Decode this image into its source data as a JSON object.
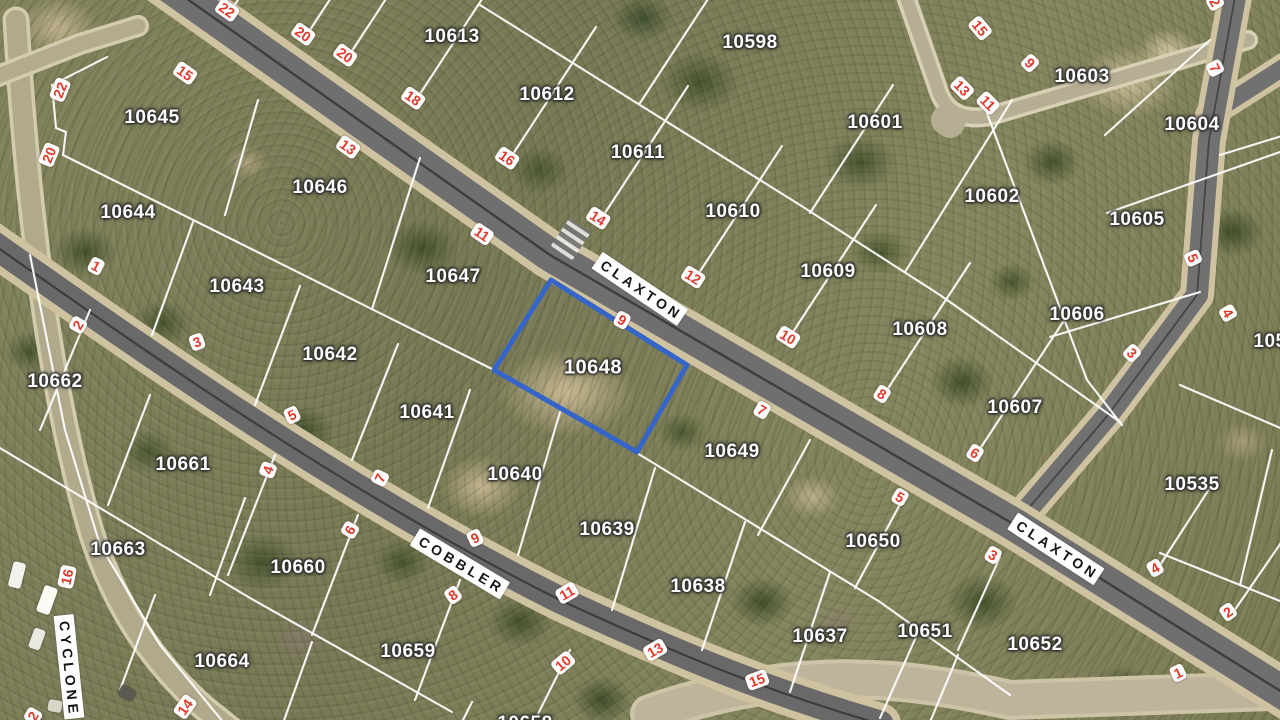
{
  "map": {
    "highlight_color": "#3565c8",
    "boundary_color": "#ffffff",
    "street_number_color": "#e23a2a",
    "selected_parcel": "10648",
    "highlight_parcel": {
      "id": "10648",
      "points": "551,280 687,365 637,452 494,370"
    },
    "street_names": [
      {
        "t": "CLAXTON",
        "x": 640,
        "y": 289,
        "r": 34
      },
      {
        "t": "CLAXTON",
        "x": 1056,
        "y": 549,
        "r": 33
      },
      {
        "t": "COBBLER",
        "x": 460,
        "y": 564,
        "r": 31
      },
      {
        "t": "CYCLONE",
        "x": 69,
        "y": 667,
        "r": 84
      }
    ],
    "parcel_labels": [
      {
        "t": "10613",
        "x": 452,
        "y": 37
      },
      {
        "t": "10612",
        "x": 547,
        "y": 95
      },
      {
        "t": "10611",
        "x": 638,
        "y": 153
      },
      {
        "t": "10610",
        "x": 733,
        "y": 212
      },
      {
        "t": "10609",
        "x": 828,
        "y": 272
      },
      {
        "t": "10608",
        "x": 920,
        "y": 330
      },
      {
        "t": "10607",
        "x": 1015,
        "y": 408
      },
      {
        "t": "10598",
        "x": 750,
        "y": 43
      },
      {
        "t": "10601",
        "x": 875,
        "y": 123
      },
      {
        "t": "10602",
        "x": 992,
        "y": 197
      },
      {
        "t": "10603",
        "x": 1082,
        "y": 77
      },
      {
        "t": "10604",
        "x": 1192,
        "y": 125
      },
      {
        "t": "10605",
        "x": 1137,
        "y": 220
      },
      {
        "t": "10606",
        "x": 1077,
        "y": 315
      },
      {
        "t": "10535",
        "x": 1192,
        "y": 485
      },
      {
        "t": "105",
        "x": 1270,
        "y": 342
      },
      {
        "t": "10645",
        "x": 152,
        "y": 118
      },
      {
        "t": "10646",
        "x": 320,
        "y": 188
      },
      {
        "t": "10647",
        "x": 453,
        "y": 277
      },
      {
        "t": "10648",
        "x": 593,
        "y": 368
      },
      {
        "t": "10649",
        "x": 732,
        "y": 452
      },
      {
        "t": "10650",
        "x": 873,
        "y": 542
      },
      {
        "t": "10644",
        "x": 128,
        "y": 213
      },
      {
        "t": "10643",
        "x": 237,
        "y": 287
      },
      {
        "t": "10642",
        "x": 330,
        "y": 355
      },
      {
        "t": "10641",
        "x": 427,
        "y": 413
      },
      {
        "t": "10640",
        "x": 515,
        "y": 475
      },
      {
        "t": "10639",
        "x": 607,
        "y": 530
      },
      {
        "t": "10638",
        "x": 698,
        "y": 587
      },
      {
        "t": "10637",
        "x": 820,
        "y": 637
      },
      {
        "t": "10651",
        "x": 925,
        "y": 632
      },
      {
        "t": "10652",
        "x": 1035,
        "y": 645
      },
      {
        "t": "10662",
        "x": 55,
        "y": 382
      },
      {
        "t": "10661",
        "x": 183,
        "y": 465
      },
      {
        "t": "10663",
        "x": 118,
        "y": 550
      },
      {
        "t": "10660",
        "x": 298,
        "y": 568
      },
      {
        "t": "10664",
        "x": 222,
        "y": 662
      },
      {
        "t": "10659",
        "x": 408,
        "y": 652
      },
      {
        "t": "10658",
        "x": 525,
        "y": 724
      }
    ],
    "street_numbers": [
      {
        "t": "22",
        "x": 227,
        "y": 10,
        "r": 35
      },
      {
        "t": "20",
        "x": 303,
        "y": 34,
        "r": 35
      },
      {
        "t": "20",
        "x": 345,
        "y": 55,
        "r": 35
      },
      {
        "t": "18",
        "x": 413,
        "y": 98,
        "r": 35
      },
      {
        "t": "16",
        "x": 507,
        "y": 158,
        "r": 34
      },
      {
        "t": "14",
        "x": 598,
        "y": 218,
        "r": 33
      },
      {
        "t": "12",
        "x": 693,
        "y": 277,
        "r": 32
      },
      {
        "t": "10",
        "x": 788,
        "y": 337,
        "r": 32
      },
      {
        "t": "8",
        "x": 882,
        "y": 394,
        "r": 32
      },
      {
        "t": "6",
        "x": 975,
        "y": 453,
        "r": 32
      },
      {
        "t": "4",
        "x": 1155,
        "y": 568,
        "r": -30
      },
      {
        "t": "2",
        "x": 1228,
        "y": 612,
        "r": -35
      },
      {
        "t": "15",
        "x": 185,
        "y": 73,
        "r": 35
      },
      {
        "t": "13",
        "x": 348,
        "y": 147,
        "r": 35
      },
      {
        "t": "11",
        "x": 482,
        "y": 234,
        "r": 34
      },
      {
        "t": "9",
        "x": 622,
        "y": 320,
        "r": 28
      },
      {
        "t": "7",
        "x": 762,
        "y": 410,
        "r": 30
      },
      {
        "t": "5",
        "x": 900,
        "y": 497,
        "r": 30
      },
      {
        "t": "3",
        "x": 993,
        "y": 555,
        "r": 30
      },
      {
        "t": "1",
        "x": 1178,
        "y": 673,
        "r": -25
      },
      {
        "t": "7",
        "x": 1215,
        "y": 68,
        "r": 62
      },
      {
        "t": "5",
        "x": 1193,
        "y": 258,
        "r": 66
      },
      {
        "t": "4",
        "x": 1228,
        "y": 313,
        "r": 60
      },
      {
        "t": "3",
        "x": 1132,
        "y": 353,
        "r": 45
      },
      {
        "t": "2",
        "x": 1215,
        "y": 2,
        "r": 60
      },
      {
        "t": "15",
        "x": 980,
        "y": 28,
        "r": 50
      },
      {
        "t": "13",
        "x": 962,
        "y": 88,
        "r": 45
      },
      {
        "t": "11",
        "x": 988,
        "y": 103,
        "r": 45
      },
      {
        "t": "9",
        "x": 1030,
        "y": 63,
        "r": 45
      },
      {
        "t": "22",
        "x": 60,
        "y": 90,
        "r": -68
      },
      {
        "t": "20",
        "x": 49,
        "y": 155,
        "r": -68
      },
      {
        "t": "16",
        "x": 67,
        "y": 577,
        "r": -78
      },
      {
        "t": "14",
        "x": 185,
        "y": 707,
        "r": -55
      },
      {
        "t": "2",
        "x": 33,
        "y": 716,
        "r": -60
      },
      {
        "t": "1",
        "x": 96,
        "y": 266,
        "r": 28
      },
      {
        "t": "3",
        "x": 197,
        "y": 342,
        "r": -20
      },
      {
        "t": "5",
        "x": 292,
        "y": 415,
        "r": -25
      },
      {
        "t": "7",
        "x": 380,
        "y": 478,
        "r": -65
      },
      {
        "t": "9",
        "x": 475,
        "y": 538,
        "r": -25
      },
      {
        "t": "11",
        "x": 567,
        "y": 593,
        "r": -30
      },
      {
        "t": "13",
        "x": 655,
        "y": 650,
        "r": -30
      },
      {
        "t": "15",
        "x": 757,
        "y": 680,
        "r": -20
      },
      {
        "t": "2",
        "x": 78,
        "y": 325,
        "r": -60
      },
      {
        "t": "4",
        "x": 268,
        "y": 470,
        "r": -70
      },
      {
        "t": "6",
        "x": 350,
        "y": 530,
        "r": -60
      },
      {
        "t": "8",
        "x": 453,
        "y": 595,
        "r": -35
      },
      {
        "t": "10",
        "x": 563,
        "y": 663,
        "r": -40
      }
    ],
    "roads": [
      {
        "name": "road-bottom-junction",
        "d": "M 650,714 C 800,662 910,678 1010,700 L 1300,690",
        "casing": {
          "c": "#cdc4a8",
          "w": 40
        },
        "surface": {
          "c": "#bdb49b",
          "w": 32
        }
      },
      {
        "name": "road-cyclone",
        "d": "M 16,20 C 28,220 52,400 92,535 C 115,605 150,660 204,708 L 250,745",
        "casing": {
          "c": "#d3cbae",
          "w": 27
        },
        "surface": {
          "c": "#b1a98c",
          "w": 20
        }
      },
      {
        "name": "road-topleft-stub",
        "d": "M -12,80 L 80,44 L 138,26",
        "casing": {
          "c": "#d3cbae",
          "w": 22
        },
        "surface": {
          "c": "#b3ab8e",
          "w": 15
        }
      },
      {
        "name": "road-culdesac-stem",
        "d": "M 903,-12 L 937,86 Q 947,124 990,116 L 1248,40",
        "casing": {
          "c": "#d8d0b4",
          "w": 20
        },
        "surface": {
          "c": "#b6ae93",
          "w": 13
        }
      },
      {
        "name": "road-culdesac-bulb",
        "d": "M 946,120 L 950,123",
        "surface": {
          "c": "#b6ae93",
          "w": 30
        }
      },
      {
        "name": "road-northeast-branch",
        "d": "M 1209,115 L 1295,60",
        "casing": {
          "c": "#cfc2a0",
          "w": 28
        },
        "surface": {
          "c": "#717171",
          "w": 17
        }
      },
      {
        "name": "road-northeast",
        "d": "M 1239,-25 L 1209,140 L 1197,295 L 1108,415 L 1016,523",
        "casing": {
          "c": "#cfc2a0",
          "w": 34
        },
        "surface": {
          "c": "#717171",
          "w": 22
        },
        "line": {
          "c": "#454545",
          "w": 1.8
        }
      },
      {
        "name": "road-cobbler",
        "d": "M -20,235 C 150,355 350,495 560,600 C 690,660 770,692 880,724",
        "casing": {
          "c": "#cfc2a0",
          "w": 42
        },
        "surface": {
          "c": "#696969",
          "w": 27
        },
        "line": {
          "c": "#3d3d3d",
          "w": 2.2
        }
      },
      {
        "name": "road-claxton",
        "d": "M 132,-40 L 550,255 L 1015,525 L 1298,702",
        "casing": {
          "c": "#cfc2a0",
          "w": 48
        },
        "surface": {
          "c": "#6f6f6f",
          "w": 33
        },
        "line": {
          "c": "#3d3d3d",
          "w": 2.4
        }
      }
    ],
    "boundaries": [
      "230,12 317,-121",
      "306,36 393,-97",
      "348,57 435,-76",
      "416,100 503,-33",
      "509,160 596,27",
      "601,219 688,86",
      "695,279 782,146",
      "789,338 876,205",
      "883,396 970,263",
      "976,455 1063,322",
      "480,5 800,205 940,295 1120,422",
      "640,103 727,-30",
      "810,213 893,85",
      "905,272 1012,100",
      "985,108 1087,380 1122,425",
      "1105,135 1210,40",
      "1107,213 1280,152",
      "1050,337 1200,292",
      "1220,155 1285,135",
      "1180,385 1285,430",
      "1160,553 1285,603",
      "1272,450 1240,585",
      "1160,565 1215,480",
      "1232,614 1285,537",
      "258,100 225,215",
      "420,158 372,309",
      "551,280 494,370",
      "688,366 637,453",
      "810,440 758,535",
      "905,495 855,588",
      "1000,557 958,650",
      "63,155 494,370 637,453 880,602 1010,695",
      "52,85 107,57",
      "52,85 56,128 66,132 63,155",
      "193,222 152,335",
      "300,286 255,405",
      "398,344 352,460",
      "470,390 428,508",
      "560,412 518,555",
      "655,468 612,610",
      "745,522 702,650",
      "830,572 790,692",
      "920,628 880,718",
      "958,655 930,722",
      "90,310 40,430",
      "150,395 108,505",
      "245,498 210,595",
      "275,455 228,575",
      "358,515 312,635",
      "460,580 415,700",
      "570,650 530,730",
      "0,448 250,598 452,712",
      "155,595 120,690",
      "312,642 282,726",
      "472,702 452,742",
      "30,255 65,430 100,545 160,645 228,728"
    ],
    "vehicles": [
      {
        "x": 10,
        "y": 562,
        "w": 13,
        "h": 26,
        "r": 14,
        "c": "#f2f2ec"
      },
      {
        "x": 40,
        "y": 586,
        "w": 14,
        "h": 28,
        "r": 20,
        "c": "#fbfbf6"
      },
      {
        "x": 31,
        "y": 628,
        "w": 12,
        "h": 21,
        "r": 20,
        "c": "#e9e9e1"
      },
      {
        "x": 119,
        "y": 687,
        "w": 16,
        "h": 12,
        "r": 30,
        "c": "#5a5a50"
      },
      {
        "x": 48,
        "y": 700,
        "w": 14,
        "h": 12,
        "r": 10,
        "c": "#d9d6c8"
      }
    ],
    "crossing_marker": {
      "x": 558,
      "y": 222,
      "w": 26,
      "h": 34,
      "r": 34
    }
  }
}
